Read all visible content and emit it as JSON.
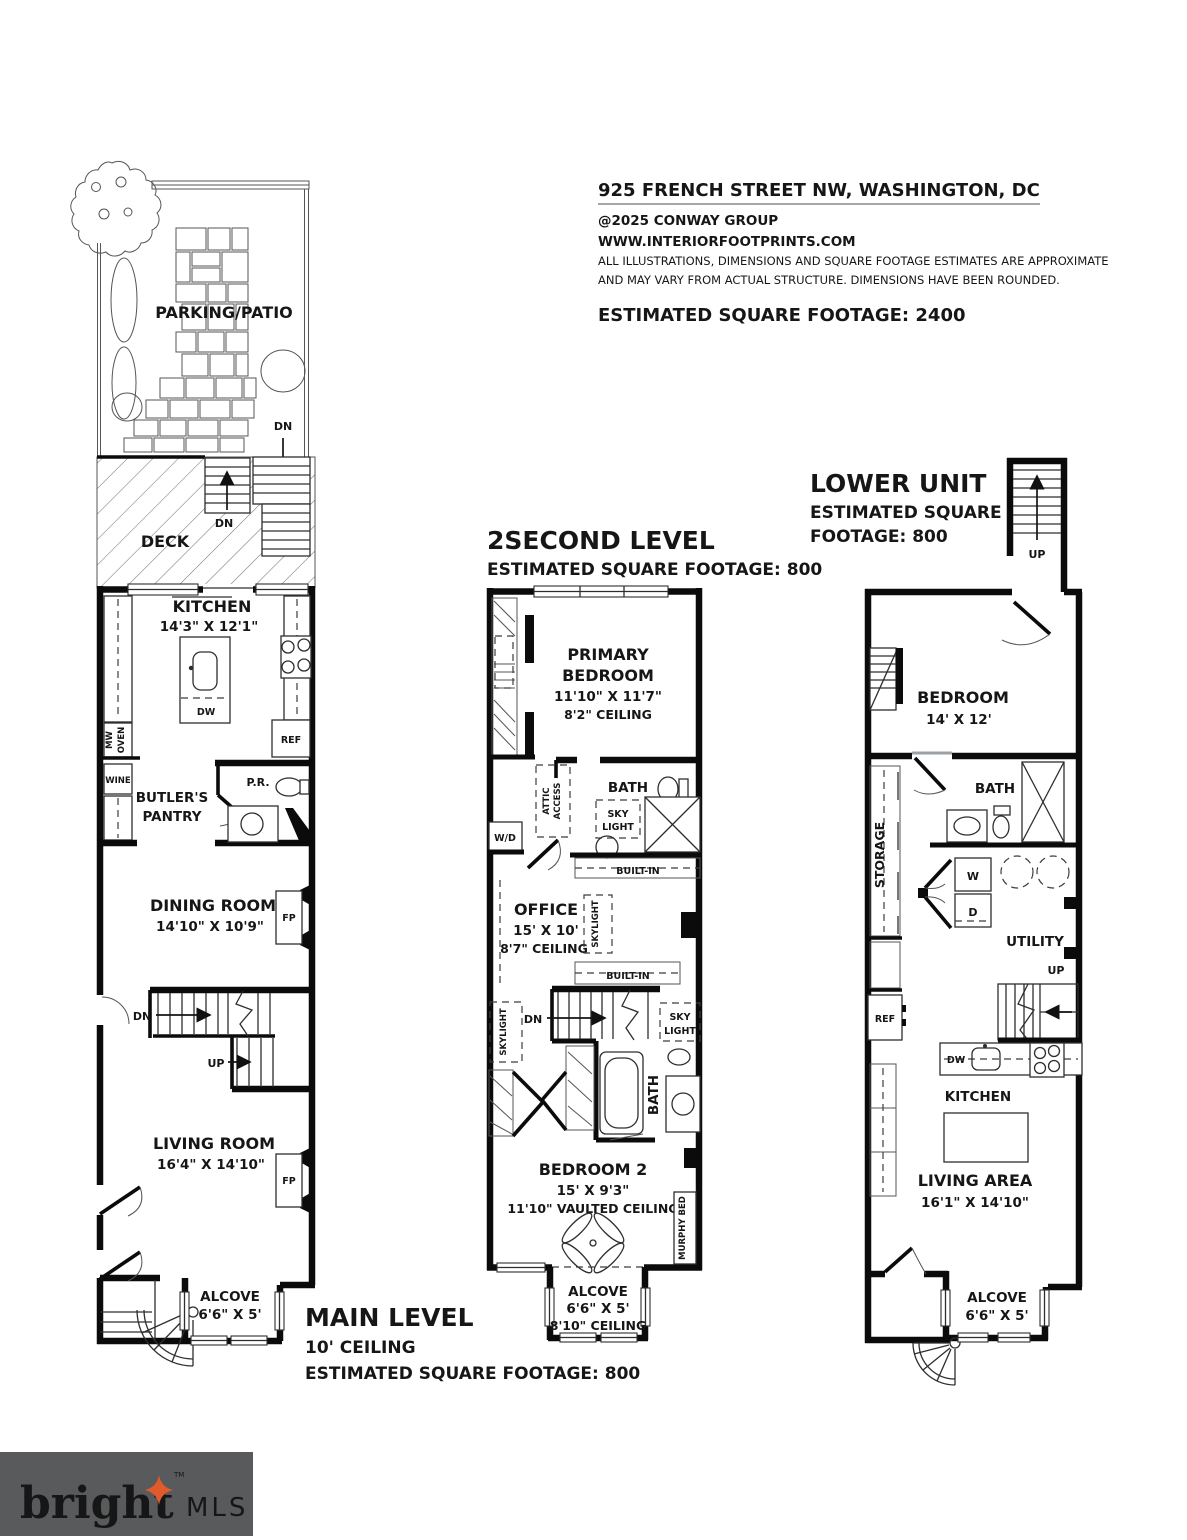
{
  "header": {
    "address": "925 FRENCH STREET NW, WASHINGTON, DC",
    "copyright": "@2025 CONWAY GROUP",
    "website": "WWW.INTERIORFOOTPRINTS.COM",
    "disclaimer1": "ALL ILLUSTRATIONS, DIMENSIONS AND SQUARE FOOTAGE ESTIMATES ARE APPROXIMATE",
    "disclaimer2": "AND MAY VARY FROM ACTUAL STRUCTURE. DIMENSIONS HAVE BEEN ROUNDED.",
    "total_sqft": "ESTIMATED SQUARE FOOTAGE: 2400"
  },
  "main": {
    "title": "MAIN LEVEL",
    "ceiling": "10' CEILING",
    "sqft": "ESTIMATED SQUARE FOOTAGE: 800",
    "parking": "PARKING/PATIO",
    "deck": "DECK",
    "dn_parking": "DN",
    "dn_deck": "DN",
    "dn_stairs": "DN",
    "up_stairs": "UP",
    "kitchen": "KITCHEN",
    "kitchen_dims": "14'3\" X 12'1\"",
    "dw": "DW",
    "mw": "MW",
    "oven": "OVEN",
    "wine": "WINE",
    "ref": "REF",
    "pr": "P.R.",
    "butlers_l1": "BUTLER'S",
    "butlers_l2": "PANTRY",
    "dining": "DINING ROOM",
    "dining_dims": "14'10\" X 10'9\"",
    "fp_dining": "FP",
    "fp_living": "FP",
    "living": "LIVING ROOM",
    "living_dims": "16'4\" X 14'10\"",
    "alcove": "ALCOVE",
    "alcove_dims": "6'6\" X 5'"
  },
  "second": {
    "title": "2SECOND LEVEL",
    "sqft": "ESTIMATED SQUARE FOOTAGE: 800",
    "primary_l1": "PRIMARY",
    "primary_l2": "BEDROOM",
    "primary_dims": "11'10\" X 11'7\"",
    "primary_ceiling": "8'2\" CEILING",
    "attic_l1": "ATTIC",
    "attic_l2": "ACCESS",
    "wd": "W/D",
    "bath_upper": "BATH",
    "sky_upper_l1": "SKY",
    "sky_upper_l2": "LIGHT",
    "builtin_top": "BUILT-IN",
    "office": "OFFICE",
    "office_dims": "15' X 10'",
    "office_ceiling": "8'7\" CEILING",
    "skylight_mid": "SKYLIGHT",
    "skylight_left": "SKYLIGHT",
    "builtin_mid": "BUILT-IN",
    "dn": "DN",
    "sky_stair_l1": "SKY",
    "sky_stair_l2": "LIGHT",
    "bath_lower": "BATH",
    "bedroom2": "BEDROOM 2",
    "bedroom2_dims": "15' X 9'3\"",
    "bedroom2_ceiling": "11'10\" VAULTED CEILING",
    "murphy": "MURPHY BED",
    "alcove": "ALCOVE",
    "alcove_dims": "6'6\" X 5'",
    "alcove_ceiling": "8'10\" CEILING"
  },
  "lower": {
    "title": "LOWER UNIT",
    "sqft_l1": "ESTIMATED SQUARE",
    "sqft_l2": "FOOTAGE: 800",
    "up_entry": "UP",
    "bedroom": "BEDROOM",
    "bedroom_dims": "14' X 12'",
    "storage": "STORAGE",
    "bath": "BATH",
    "w": "W",
    "d": "D",
    "utility": "UTILITY",
    "up_interior": "UP",
    "ref": "REF",
    "dw": "DW",
    "kitchen": "KITCHEN",
    "living": "LIVING AREA",
    "living_dims": "16'1\" X 14'10\"",
    "alcove": "ALCOVE",
    "alcove_dims": "6'6\" X 5'"
  },
  "footer": {
    "brand": "bright",
    "tm": "TM",
    "mls": "MLS"
  },
  "colors": {
    "bar": "#595a5c",
    "star": "#e05a2b",
    "ink": "#111111"
  }
}
